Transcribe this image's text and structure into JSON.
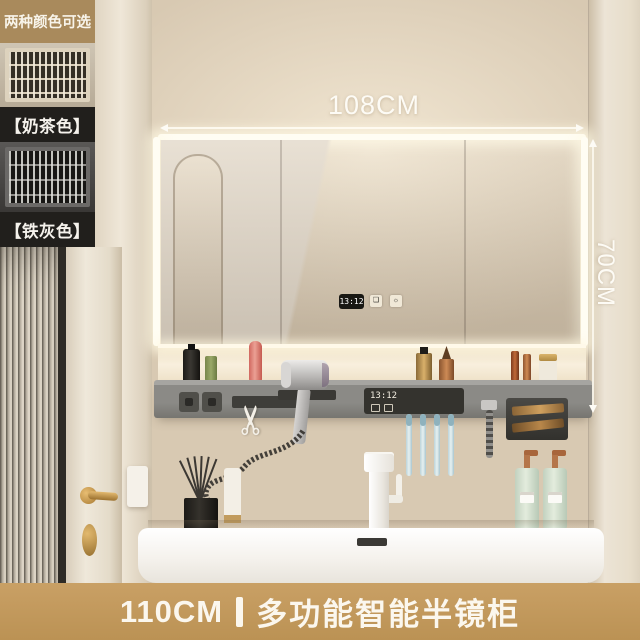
{
  "options_panel": {
    "header": "两种颜色可选",
    "options": [
      {
        "label": "【奶茶色】"
      },
      {
        "label": "【铁灰色】"
      }
    ]
  },
  "annotations": {
    "width_label": "108CM",
    "height_label": "70CM"
  },
  "mirror": {
    "clock_time": "13:12",
    "button_icons": [
      "defog-icon",
      "light-icon"
    ]
  },
  "shelf_panel": {
    "clock_time": "13:12"
  },
  "banner": {
    "size": "110CM",
    "title": "多功能智能半镜柜"
  },
  "icons": {
    "scissors": "✂",
    "defog": "❏",
    "light": "☼"
  },
  "colors": {
    "banner_gold": "#c49c61",
    "header_tan": "#a98a5c",
    "label_black": "#211f1c",
    "wall_beige": "#d8c9b2",
    "led_white": "#fffdf3",
    "dimension_text": "#fdfbf5"
  }
}
